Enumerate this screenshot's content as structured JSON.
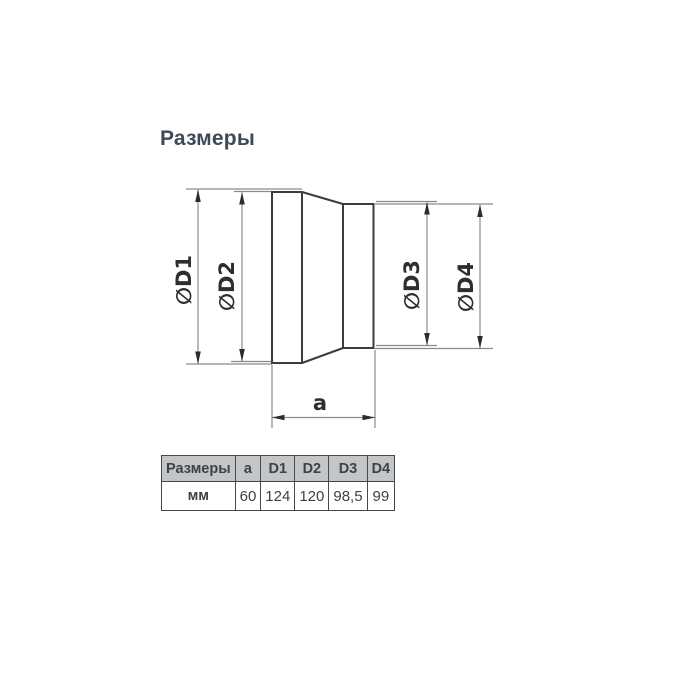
{
  "title": "Размеры",
  "diagram": {
    "labels": {
      "d1": "∅D1",
      "d2": "∅D2",
      "d3": "∅D3",
      "d4": "∅D4",
      "a": "a"
    }
  },
  "table": {
    "headers": [
      "Размеры",
      "a",
      "D1",
      "D2",
      "D3",
      "D4"
    ],
    "row": [
      "мм",
      "60",
      "124",
      "120",
      "98,5",
      "99"
    ]
  },
  "colors": {
    "title_text": "#3e4a58",
    "outline": "#3c3c3c",
    "dim_line": "#8b8b8b",
    "arrow": "#2c2c2c",
    "label_text": "#2e2e2e",
    "table_header_bg": "#c3c6c8",
    "table_border": "#45494c",
    "table_text": "#3c4248"
  }
}
